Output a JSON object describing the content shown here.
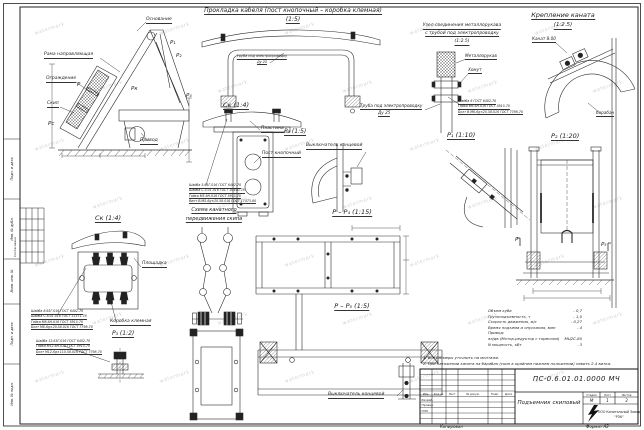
{
  "sheet": {
    "copied_label": "Копировал",
    "format_label": "Формат А2",
    "watermark_text": "watermark",
    "coordination_label": "Согласовано"
  },
  "side_stamp": {
    "cells": [
      "Подп. и дата",
      "Инв. № дубл.",
      "Взам. инв. №",
      "Подп. и дата",
      "Инв. № подл."
    ]
  },
  "views": {
    "general": {
      "labels": {
        "osnovanie": "Основание",
        "rama": "Рама направляющая",
        "ograzhdenie": "Ограждение",
        "skip": "Скип",
        "privod": "Привод"
      },
      "marks": {
        "p1": "Р₁",
        "p2": "Р₂",
        "pk": "Рк",
        "p": "Р",
        "ps": "Рс",
        "p4": "Р₄"
      }
    },
    "cable": {
      "title": "Прокладка кабеля (пост кнопочный – коробка клемная)",
      "scale": "(1:5)",
      "tube_label_line1": "Труба под электропроводку",
      "tube_label_line2": "Ду 25"
    },
    "sleeve_unit": {
      "title_line1": "Узел соединения металлорукава",
      "title_line2": "с трубой под электропроводку",
      "scale": "(1:2.5)",
      "metallorukav": "Металлорукав",
      "khomut": "Хомут",
      "callout": [
        "Шайба 6 ГОСТ 6402-70",
        "Гайка М6-6Н.016 ГОСТ 5915-70",
        "Болт В.М6-6g×25.58.016 ГОСТ 7798-70"
      ],
      "tube_label_line1": "Труба под электропроводку",
      "tube_label_line2": "Ду 25"
    },
    "rope_mount": {
      "title": "Крепление каната",
      "scale": "(1:2.5)",
      "rope": "Канат 8.00",
      "drum": "барабан"
    },
    "button_post": {
      "view_label": "Ск (1:4)",
      "plastina": "Пластина",
      "post": "Пост кнопочный",
      "callout": [
        "Шайба 5.65Г.016 ГОСТ 6402-70",
        "Шайба С.5.01.016 ГОСТ 10450-78",
        "Гайка М5-6Н.016 ГОСТ 5915-70",
        "Винт В.М5-6g×20.58.016 ГОСТ 17473-80"
      ]
    },
    "limit_switch_side": {
      "view_label": "Р₃ (1:5)",
      "label": "Выключатель концевой"
    },
    "p1": {
      "view_label": "Р₁ (1:10)"
    },
    "p2": {
      "view_label": "Р₂ (1:20)",
      "mark_left": "Р",
      "mark_right": "Р₅"
    },
    "terminal_box": {
      "view_label": "Ск (1:4)",
      "ploshchadka": "Площадка",
      "korobka": "Коробка клемная",
      "detail_label": "Р₃ (1:2)",
      "callout_upper": [
        "Шайба 8.65Г.016 ГОСТ 6402-70",
        "Шайба С.8.01.016 ГОСТ 11371-78",
        "Гайка М8-6Н.016 ГОСТ 5915-70",
        "Болт М8-6g×20.58.016 ГОСТ 7798-70"
      ],
      "callout_lower": [
        "Шайба 12.65Г.016 ГОСТ 6402-70",
        "Гайка М12-6Н.016 ГОСТ 5915-70",
        "Болт М12-6g×110.58.016 ГОСТ 7798-70"
      ]
    },
    "rope_scheme": {
      "title_line1": "Схема канатного",
      "title_line2": "передвижения скипа"
    },
    "pp4": {
      "view_label": "Р – Р₄ (1:15)"
    },
    "pp5": {
      "view_label": "Р – Р₅ (1:5)",
      "label": "Выключатель концевой"
    }
  },
  "specs": {
    "lines": [
      {
        "label": "Объем куба",
        "value": "- 0,7"
      },
      {
        "label": "Грузоподъемность, т",
        "value": "- 1,0"
      },
      {
        "label": "Скорость движения, м/с",
        "value": "- 0,27"
      },
      {
        "label": "Время подъема и опускания, мин",
        "value": "- 4"
      },
      {
        "label": "Привод:",
        "value": ""
      },
      {
        "label": "эл/дв (Мотор-редуктор с тормозом)",
        "value": "МЦ2С-80"
      },
      {
        "label": "N мощность, кВт",
        "value": "- 3"
      }
    ]
  },
  "notes": [
    "1. Все размеры уточнить на монтаже.",
    "2. При натяжении каната на барабан (скип в крайнем нижнем положении) навить 2-4 витка."
  ],
  "title_block": {
    "doc_number": "ПС-0.6.01.01.0000 МЧ",
    "doc_title": "Подъемник скиповый",
    "header_cols": [
      "Изм.",
      "Кол.уч.",
      "Лист",
      "№ докум.",
      "Подп.",
      "Дата"
    ],
    "rows": [
      "Разраб.",
      "Провер.",
      "ГИП"
    ],
    "stage_header": [
      "Стадия",
      "Лист",
      "Листов"
    ],
    "stage_values": [
      "М",
      "1",
      "3"
    ],
    "company_line1": "ООО Капитальный Завод",
    "company_line2": "\"РЗК\""
  }
}
